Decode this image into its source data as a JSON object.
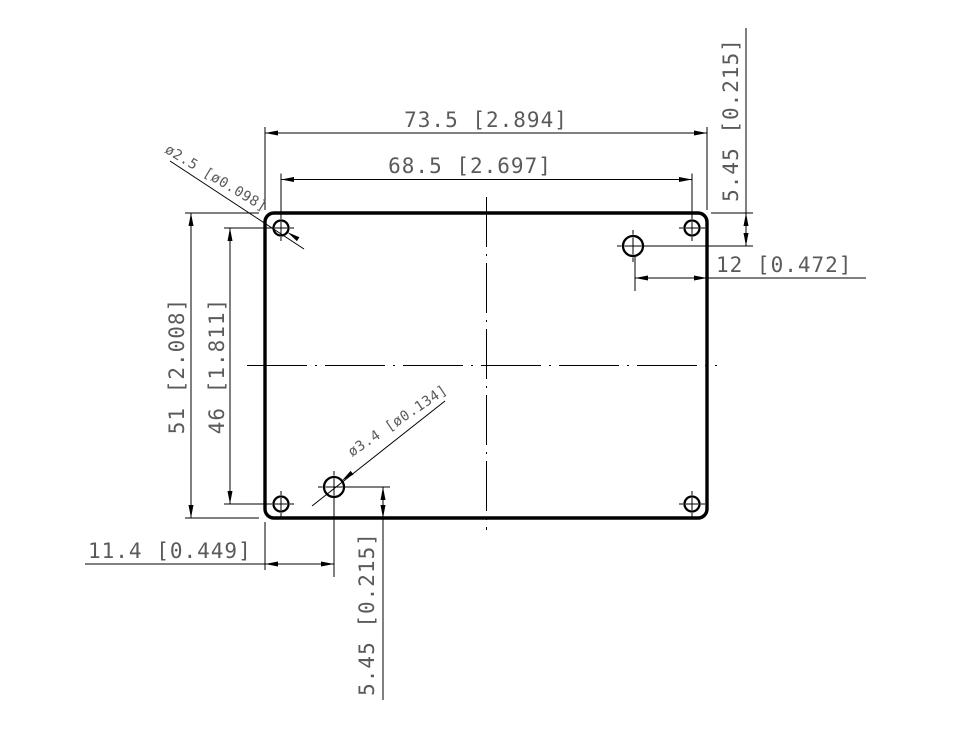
{
  "colors": {
    "line": "#000000",
    "dim_text": "#5a5a5a",
    "background": "#ffffff"
  },
  "dims": {
    "overall_width": "73.5 [2.894]",
    "hole_span_width": "68.5 [2.697]",
    "overall_height": "51 [2.008]",
    "hole_span_height": "46 [1.811]",
    "top_right_hole_vertical": "5.45 [0.215]",
    "top_right_hole_horizontal": "12 [0.472]",
    "bottom_left_hole_horizontal": "11.4 [0.449]",
    "bottom_left_hole_vertical": "5.45 [0.215]",
    "corner_hole_diameter": "ø2.5 [ø0.098]",
    "offset_hole_diameter": "ø3.4 [ø0.134]"
  }
}
